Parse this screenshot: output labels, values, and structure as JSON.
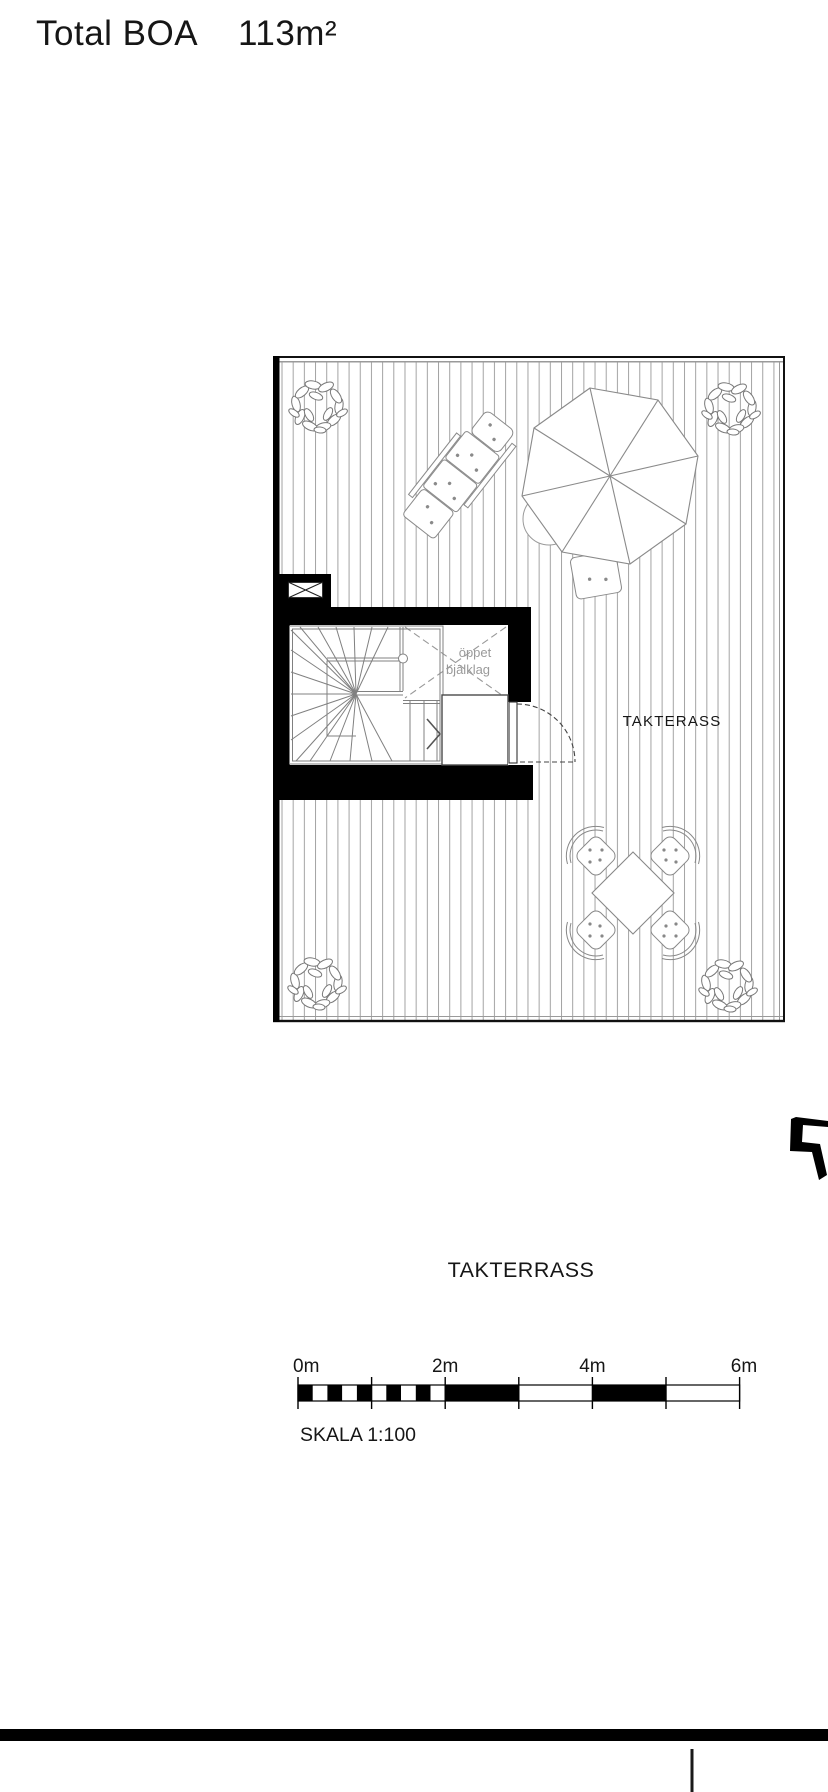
{
  "header": {
    "title": "Total BOA",
    "area_value": "113m²"
  },
  "plan": {
    "room_label": "TAKTERASS",
    "open_joist_line1": "öppet",
    "open_joist_line2": "bjälklag"
  },
  "caption": "TAKTERRASS",
  "scale_bar": {
    "ticks": [
      "0m",
      "2m",
      "4m",
      "6m"
    ],
    "scale_label": "SKALA 1:100"
  },
  "colors": {
    "black_fill": "#000000",
    "deck_line": "#a3a3a3",
    "muted_text": "#9a9a9a",
    "line": "#1a1a1a"
  }
}
